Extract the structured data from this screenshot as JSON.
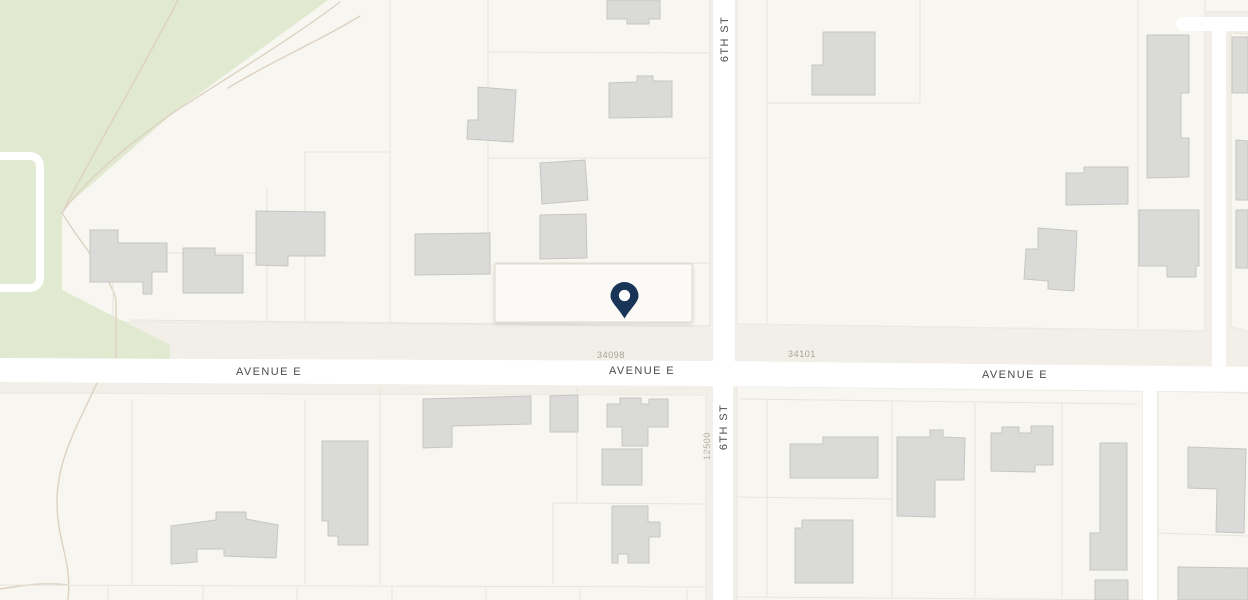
{
  "map": {
    "street_labels": {
      "avenue_e": "AVENUE E",
      "sixth_st": "6TH ST"
    },
    "parcel_labels": {
      "left_block_number": "34098",
      "right_block_number": "34101",
      "south_block_number": "12500"
    },
    "marker": {
      "type": "location-pin"
    }
  },
  "colors": {
    "background": "#f2efe9",
    "block": "#f8f6f1",
    "block_border": "#eceae3",
    "selected_parcel": "#fbfaf6",
    "selected_parcel_border": "#dfdbd2",
    "road": "#ffffff",
    "park": "#e1e9d0",
    "trail": "#ddd2c2",
    "building_fill": "#dadad8",
    "building_stroke": "#c6c5c2",
    "parcel_line": "#e8e4dc",
    "street_label": "#4c4c4c",
    "parcel_number": "#a8a49c",
    "parcel_number_light": "#b7b3ab",
    "pin": "#183457",
    "pin_dot": "#ffffff"
  }
}
